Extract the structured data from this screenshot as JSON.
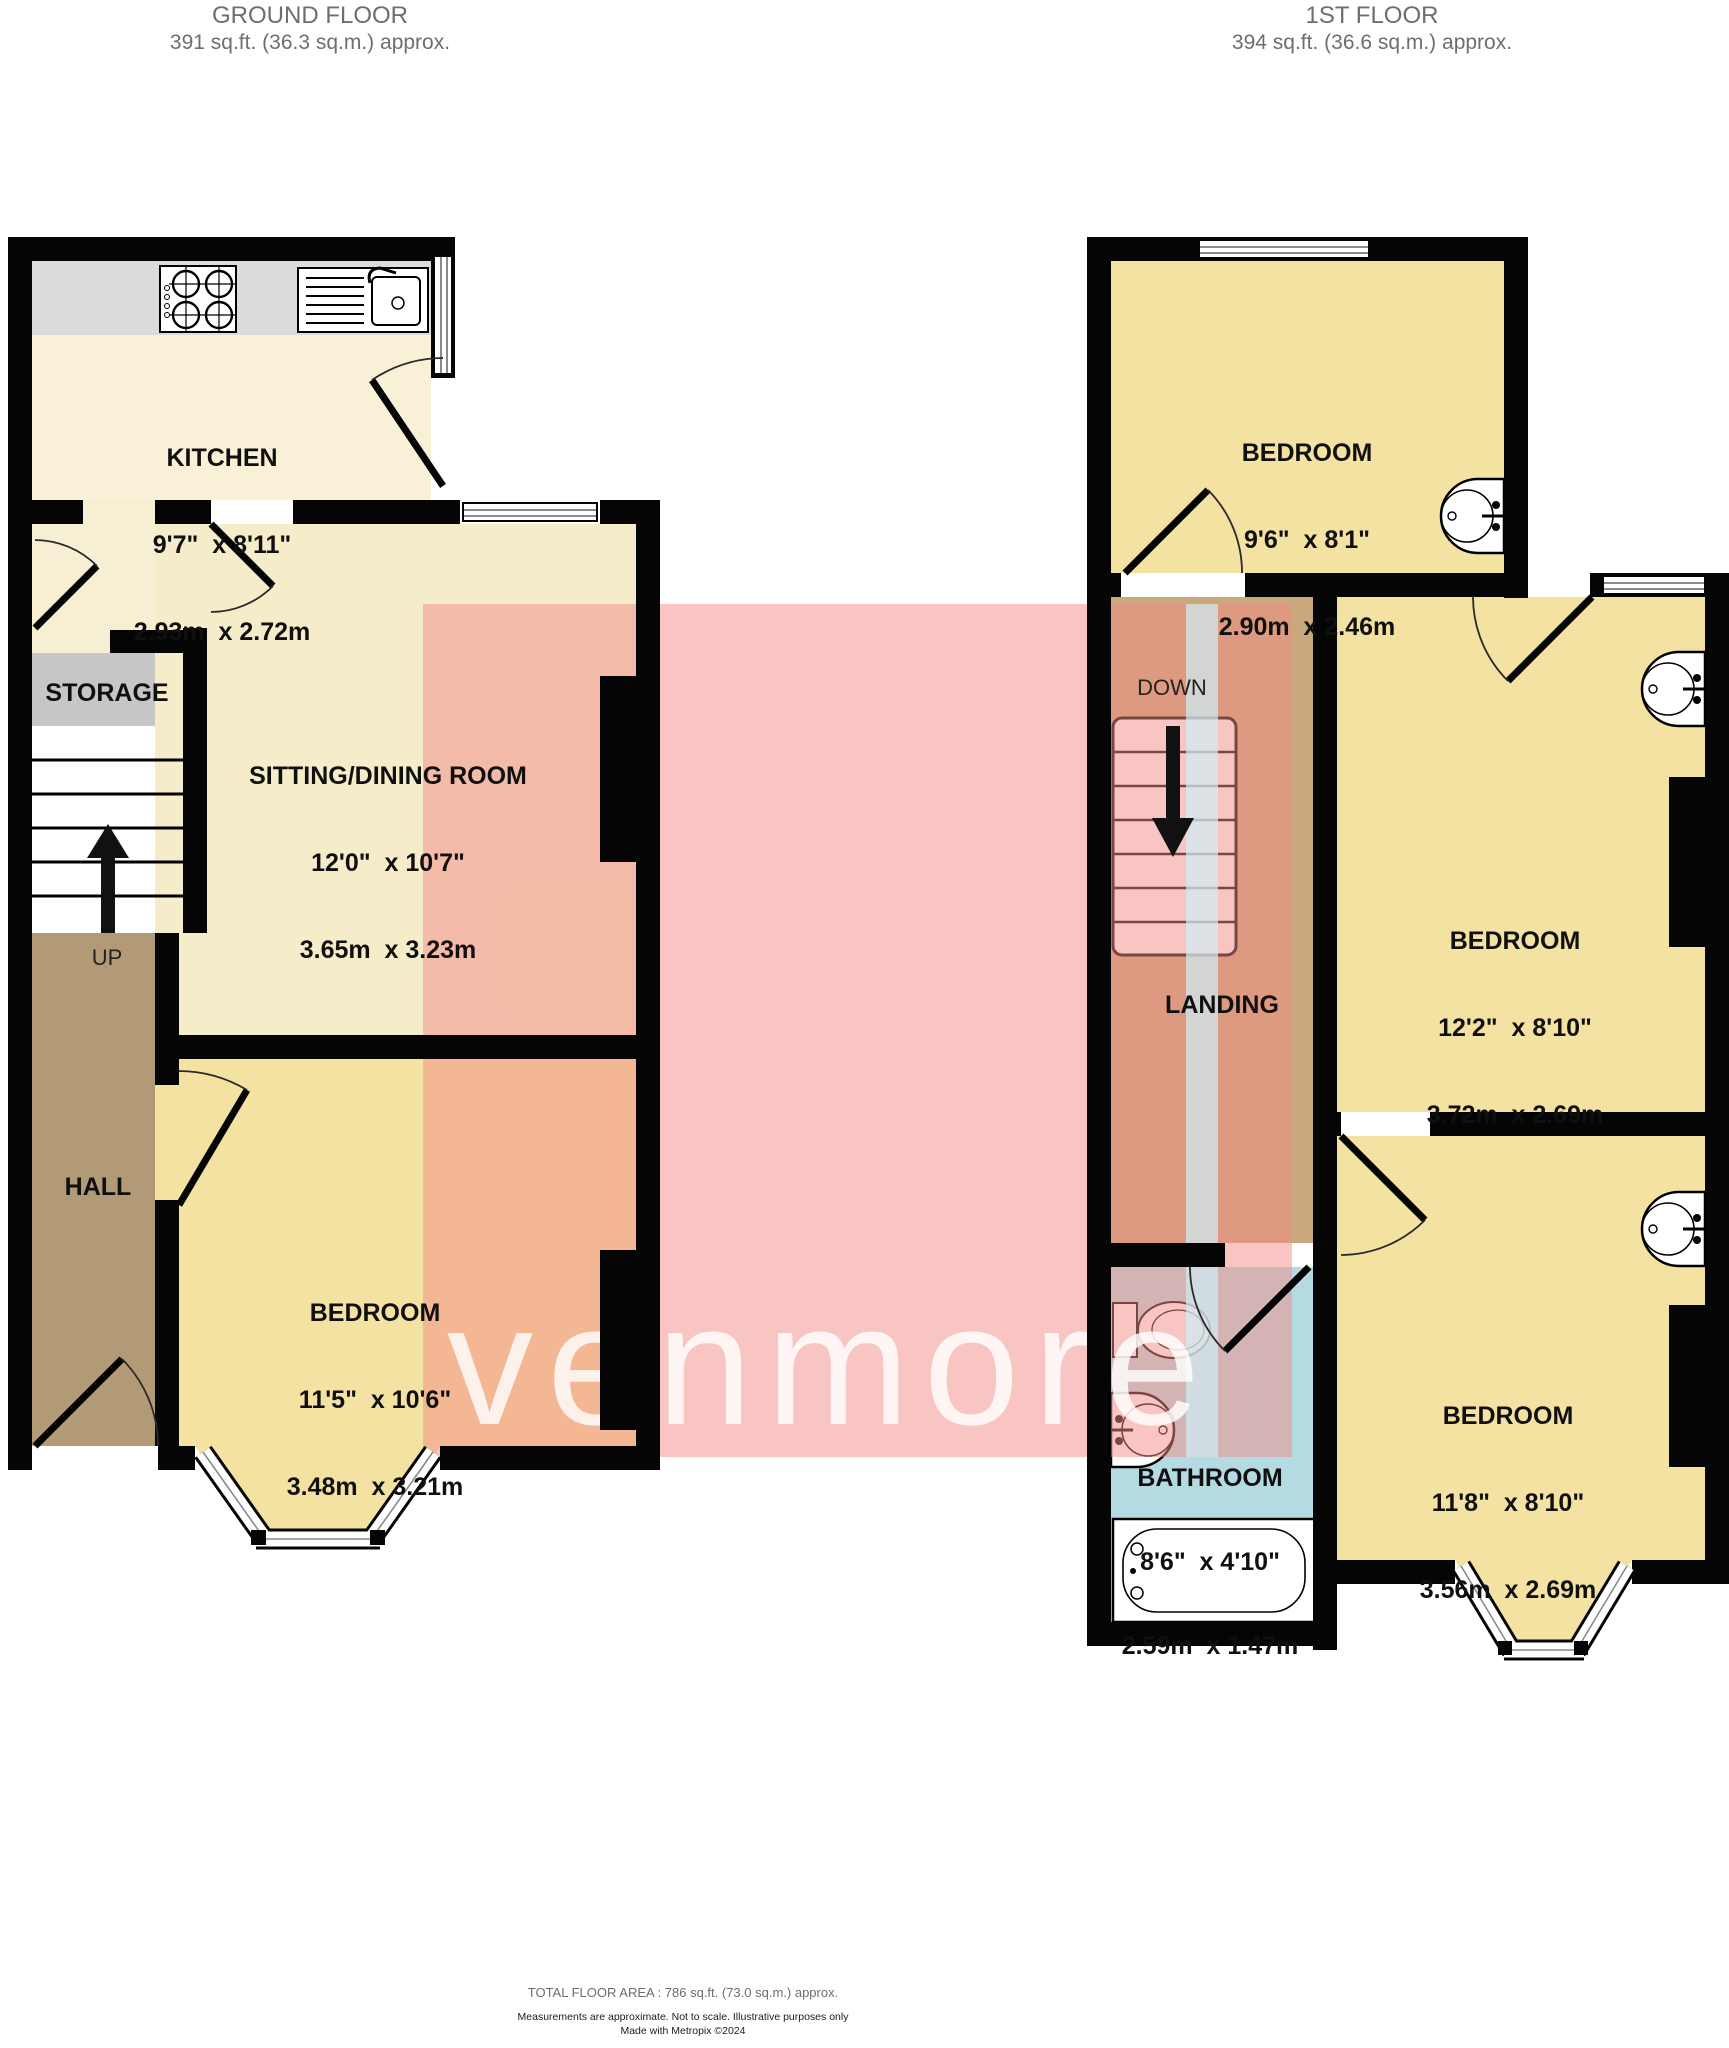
{
  "header_left": {
    "title": "GROUND FLOOR",
    "subtitle": "391 sq.ft. (36.3 sq.m.) approx."
  },
  "header_right": {
    "title": "1ST FLOOR",
    "subtitle": "394 sq.ft. (36.6 sq.m.) approx."
  },
  "watermark": {
    "text": "venmore"
  },
  "ground_floor": {
    "kitchen": {
      "name": "KITCHEN",
      "dims_imperial": "9'7\"  x 8'11\"",
      "dims_metric": "2.93m  x 2.72m"
    },
    "sitting": {
      "name": "SITTING/DINING ROOM",
      "dims_imperial": "12'0\"  x 10'7\"",
      "dims_metric": "3.65m  x 3.23m"
    },
    "bedroom": {
      "name": "BEDROOM",
      "dims_imperial": "11'5\"  x 10'6\"",
      "dims_metric": "3.48m  x 3.21m"
    },
    "storage_label": "STORAGE",
    "hall_label": "HALL",
    "up_label": "UP"
  },
  "first_floor": {
    "bedroom_rear": {
      "name": "BEDROOM",
      "dims_imperial": "9'6\"  x 8'1\"",
      "dims_metric": "2.90m  x 2.46m"
    },
    "bedroom_middle": {
      "name": "BEDROOM",
      "dims_imperial": "12'2\"  x 8'10\"",
      "dims_metric": "3.72m  x 2.69m"
    },
    "bedroom_front": {
      "name": "BEDROOM",
      "dims_imperial": "11'8\"  x 8'10\"",
      "dims_metric": "3.56m  x 2.69m"
    },
    "bathroom": {
      "name": "BATHROOM",
      "dims_imperial": "8'6\"  x 4'10\"",
      "dims_metric": "2.59m  x 1.47m"
    },
    "landing_label": "LANDING",
    "down_label": "DOWN"
  },
  "footer": {
    "total": "TOTAL FLOOR AREA : 786 sq.ft. (73.0 sq.m.) approx.",
    "note": "Measurements are approximate.  Not to scale.  Illustrative purposes only",
    "credit": "Made with Metropix ©2024"
  },
  "colors": {
    "wall": "#050505",
    "kitchen_floor": "#f8f1d7",
    "counter": "#dcdcdc",
    "sitting_floor": "#f5ecca",
    "bedroom_floor": "#f3e2a1",
    "hall_floor": "#b19a75",
    "landing_floor": "#c9a87d",
    "storage_floor": "#c6c6c6",
    "bathroom_floor": "#b5dbe2",
    "watermark_pink": "#f38c85",
    "watermark_bar": "#cfecf3",
    "header_gray": "#6e6e6e"
  }
}
